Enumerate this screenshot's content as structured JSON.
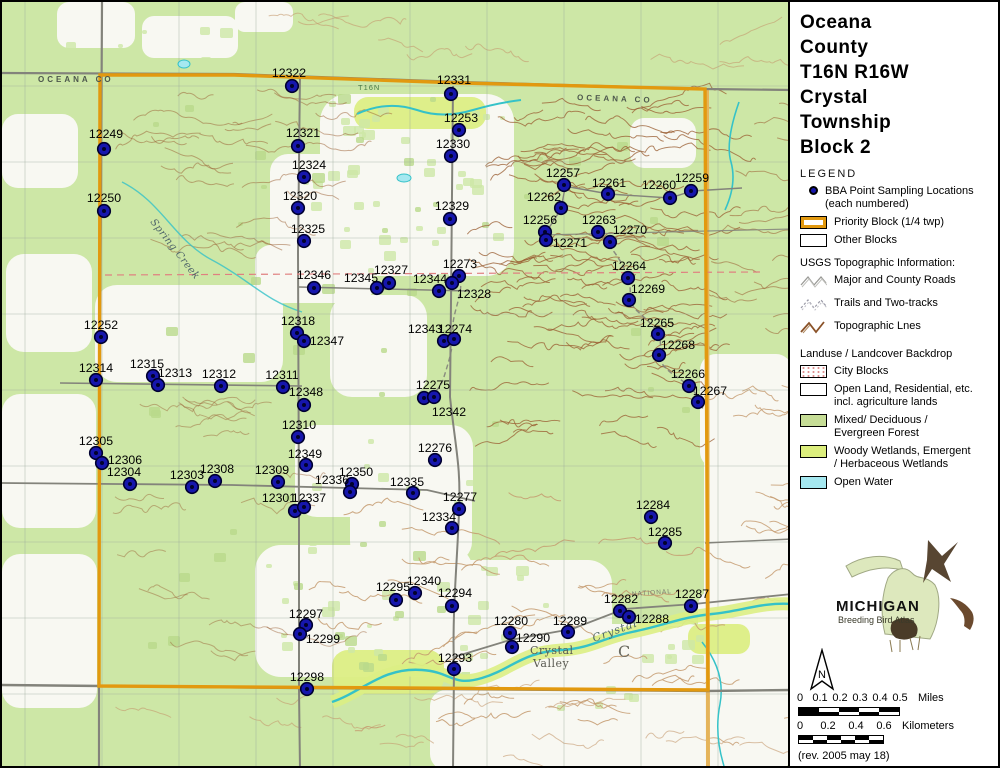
{
  "sidebar": {
    "title_lines": [
      "Oceana",
      "County",
      "T16N R16W",
      "Crystal",
      "Township",
      "Block 2"
    ],
    "legend": {
      "heading": "LEGEND",
      "bba_line1": "BBA Point Sampling Locations",
      "bba_line2": "(each numbered)",
      "priority": "Priority Block (1/4 twp)",
      "other": "Other Blocks",
      "usgs_heading": "USGS Topographic Information:",
      "roads": "Major and County Roads",
      "trails": "Trails and Two-tracks",
      "topo": "Topographic Lnes",
      "landuse_heading": "Landuse / Landcover Backdrop",
      "city": "City Blocks",
      "open1": "Open Land, Residential, etc.",
      "open2": "incl. agriculture lands",
      "forest1": "Mixed/ Deciduous /",
      "forest2": "Evergreen Forest",
      "wetland1": "Woody Wetlands, Emergent",
      "wetland2": "/ Herbaceous Wetlands",
      "water": "Open Water"
    },
    "logo": {
      "title": "MICHIGAN",
      "subtitle": "Breeding Bird Atlas"
    },
    "north_label": "N",
    "scalebar": {
      "miles_ticks": [
        "0",
        "0.1",
        "0.2",
        "0.3",
        "0.4",
        "0.5"
      ],
      "miles_unit": "Miles",
      "km_ticks": [
        "0",
        "0.2",
        "0.4",
        "0.6"
      ],
      "km_unit": "Kilometers"
    },
    "revision": "(rev. 2005 may 18)"
  },
  "map": {
    "annotations": [
      {
        "text": "OCEANA  CO",
        "x": 36,
        "y": 80,
        "rot": 0,
        "cls": "county"
      },
      {
        "text": "OCEANA  CO",
        "x": 575,
        "y": 98,
        "rot": 2,
        "cls": "county"
      },
      {
        "text": "T16N",
        "x": 356,
        "y": 88,
        "rot": 0,
        "cls": "tiny2"
      },
      {
        "text": "Spring  Creek",
        "x": 148,
        "y": 220,
        "rot": 52,
        "cls": "creek"
      },
      {
        "text": "NATIONAL",
        "x": 630,
        "y": 594,
        "rot": -4,
        "cls": "tiny"
      },
      {
        "text": "Crystal",
        "x": 528,
        "y": 652,
        "rot": 0,
        "cls": "place"
      },
      {
        "text": "Valley",
        "x": 531,
        "y": 665,
        "rot": 0,
        "cls": "place"
      },
      {
        "text": "Crystal",
        "x": 592,
        "y": 640,
        "rot": -20,
        "cls": "creekbig"
      },
      {
        "text": "C",
        "x": 616,
        "y": 655,
        "rot": 0,
        "cls": "bigc"
      }
    ],
    "points": [
      {
        "n": "12322",
        "x": 290,
        "y": 84,
        "lx": 287,
        "ly": 75
      },
      {
        "n": "12331",
        "x": 449,
        "y": 92,
        "lx": 452,
        "ly": 82
      },
      {
        "n": "12253",
        "x": 457,
        "y": 128,
        "lx": 459,
        "ly": 120
      },
      {
        "n": "12249",
        "x": 102,
        "y": 147,
        "lx": 104,
        "ly": 136
      },
      {
        "n": "12330",
        "x": 449,
        "y": 154,
        "lx": 451,
        "ly": 146
      },
      {
        "n": "12321",
        "x": 296,
        "y": 144,
        "lx": 301,
        "ly": 135
      },
      {
        "n": "12324",
        "x": 302,
        "y": 175,
        "lx": 307,
        "ly": 167
      },
      {
        "n": "12257",
        "x": 562,
        "y": 183,
        "lx": 561,
        "ly": 175
      },
      {
        "n": "12261",
        "x": 606,
        "y": 192,
        "lx": 607,
        "ly": 185
      },
      {
        "n": "12260",
        "x": 668,
        "y": 196,
        "lx": 657,
        "ly": 187
      },
      {
        "n": "12259",
        "x": 689,
        "y": 189,
        "lx": 690,
        "ly": 180
      },
      {
        "n": "12250",
        "x": 102,
        "y": 209,
        "lx": 102,
        "ly": 200
      },
      {
        "n": "12320",
        "x": 296,
        "y": 206,
        "lx": 298,
        "ly": 198
      },
      {
        "n": "12329",
        "x": 448,
        "y": 217,
        "lx": 450,
        "ly": 208
      },
      {
        "n": "12262",
        "x": 559,
        "y": 206,
        "lx": 542,
        "ly": 199
      },
      {
        "n": "12263",
        "x": 596,
        "y": 230,
        "lx": 597,
        "ly": 222
      },
      {
        "n": "12256",
        "x": 543,
        "y": 230,
        "lx": 538,
        "ly": 222
      },
      {
        "n": "12270",
        "x": 608,
        "y": 240,
        "lx": 628,
        "ly": 232
      },
      {
        "n": "12325",
        "x": 302,
        "y": 239,
        "lx": 306,
        "ly": 231
      },
      {
        "n": "12271",
        "x": 544,
        "y": 238,
        "lx": 568,
        "ly": 245
      },
      {
        "n": "12264",
        "x": 626,
        "y": 276,
        "lx": 627,
        "ly": 268
      },
      {
        "n": "12273",
        "x": 457,
        "y": 274,
        "lx": 458,
        "ly": 266
      },
      {
        "n": "12327",
        "x": 387,
        "y": 281,
        "lx": 389,
        "ly": 272
      },
      {
        "n": "12345",
        "x": 375,
        "y": 286,
        "lx": 359,
        "ly": 280
      },
      {
        "n": "12346",
        "x": 312,
        "y": 286,
        "lx": 312,
        "ly": 277
      },
      {
        "n": "12344",
        "x": 437,
        "y": 289,
        "lx": 428,
        "ly": 281
      },
      {
        "n": "12328",
        "x": 450,
        "y": 281,
        "lx": 472,
        "ly": 296
      },
      {
        "n": "12269",
        "x": 627,
        "y": 298,
        "lx": 646,
        "ly": 291
      },
      {
        "n": "12265",
        "x": 656,
        "y": 332,
        "lx": 655,
        "ly": 325
      },
      {
        "n": "12268",
        "x": 657,
        "y": 353,
        "lx": 676,
        "ly": 347
      },
      {
        "n": "12252",
        "x": 99,
        "y": 335,
        "lx": 99,
        "ly": 327
      },
      {
        "n": "12318",
        "x": 295,
        "y": 331,
        "lx": 296,
        "ly": 323
      },
      {
        "n": "12343",
        "x": 442,
        "y": 339,
        "lx": 423,
        "ly": 331
      },
      {
        "n": "12274",
        "x": 452,
        "y": 337,
        "lx": 453,
        "ly": 331
      },
      {
        "n": "12347",
        "x": 302,
        "y": 339,
        "lx": 325,
        "ly": 343
      },
      {
        "n": "12314",
        "x": 94,
        "y": 378,
        "lx": 94,
        "ly": 370
      },
      {
        "n": "12315",
        "x": 151,
        "y": 374,
        "lx": 145,
        "ly": 366
      },
      {
        "n": "12313",
        "x": 156,
        "y": 383,
        "lx": 173,
        "ly": 375
      },
      {
        "n": "12312",
        "x": 219,
        "y": 384,
        "lx": 217,
        "ly": 376
      },
      {
        "n": "12311",
        "x": 281,
        "y": 385,
        "lx": 280,
        "ly": 377
      },
      {
        "n": "12266",
        "x": 687,
        "y": 384,
        "lx": 686,
        "ly": 376
      },
      {
        "n": "12275",
        "x": 422,
        "y": 396,
        "lx": 431,
        "ly": 387
      },
      {
        "n": "12267",
        "x": 696,
        "y": 400,
        "lx": 708,
        "ly": 393
      },
      {
        "n": "12348",
        "x": 302,
        "y": 403,
        "lx": 304,
        "ly": 394
      },
      {
        "n": "12342",
        "x": 432,
        "y": 395,
        "lx": 447,
        "ly": 414
      },
      {
        "n": "12310",
        "x": 296,
        "y": 435,
        "lx": 297,
        "ly": 427
      },
      {
        "n": "12305",
        "x": 94,
        "y": 451,
        "lx": 94,
        "ly": 443
      },
      {
        "n": "12306",
        "x": 100,
        "y": 461,
        "lx": 123,
        "ly": 462
      },
      {
        "n": "12349",
        "x": 304,
        "y": 463,
        "lx": 303,
        "ly": 456
      },
      {
        "n": "12276",
        "x": 433,
        "y": 458,
        "lx": 433,
        "ly": 450
      },
      {
        "n": "12304",
        "x": 128,
        "y": 482,
        "lx": 122,
        "ly": 474
      },
      {
        "n": "12303",
        "x": 190,
        "y": 485,
        "lx": 185,
        "ly": 477
      },
      {
        "n": "12308",
        "x": 213,
        "y": 479,
        "lx": 215,
        "ly": 471
      },
      {
        "n": "12309",
        "x": 276,
        "y": 480,
        "lx": 270,
        "ly": 472
      },
      {
        "n": "12350",
        "x": 350,
        "y": 482,
        "lx": 354,
        "ly": 474
      },
      {
        "n": "12335",
        "x": 411,
        "y": 491,
        "lx": 405,
        "ly": 484
      },
      {
        "n": "12336",
        "x": 348,
        "y": 490,
        "lx": 330,
        "ly": 482
      },
      {
        "n": "12277",
        "x": 457,
        "y": 507,
        "lx": 458,
        "ly": 499
      },
      {
        "n": "12301",
        "x": 293,
        "y": 509,
        "lx": 277,
        "ly": 500
      },
      {
        "n": "12337",
        "x": 302,
        "y": 505,
        "lx": 307,
        "ly": 500
      },
      {
        "n": "12334",
        "x": 450,
        "y": 526,
        "lx": 437,
        "ly": 519
      },
      {
        "n": "12284",
        "x": 649,
        "y": 515,
        "lx": 651,
        "ly": 507
      },
      {
        "n": "12285",
        "x": 663,
        "y": 541,
        "lx": 663,
        "ly": 534
      },
      {
        "n": "12340",
        "x": 413,
        "y": 591,
        "lx": 422,
        "ly": 583
      },
      {
        "n": "12295",
        "x": 394,
        "y": 598,
        "lx": 391,
        "ly": 589
      },
      {
        "n": "12294",
        "x": 450,
        "y": 604,
        "lx": 453,
        "ly": 595
      },
      {
        "n": "12287",
        "x": 689,
        "y": 604,
        "lx": 690,
        "ly": 596
      },
      {
        "n": "12282",
        "x": 618,
        "y": 609,
        "lx": 619,
        "ly": 601
      },
      {
        "n": "12288",
        "x": 627,
        "y": 615,
        "lx": 650,
        "ly": 621
      },
      {
        "n": "12289",
        "x": 566,
        "y": 630,
        "lx": 568,
        "ly": 623
      },
      {
        "n": "12280",
        "x": 508,
        "y": 631,
        "lx": 509,
        "ly": 623
      },
      {
        "n": "12290",
        "x": 510,
        "y": 645,
        "lx": 531,
        "ly": 640
      },
      {
        "n": "12297",
        "x": 304,
        "y": 623,
        "lx": 304,
        "ly": 616
      },
      {
        "n": "12299",
        "x": 298,
        "y": 632,
        "lx": 321,
        "ly": 641
      },
      {
        "n": "12293",
        "x": 452,
        "y": 667,
        "lx": 453,
        "ly": 660
      },
      {
        "n": "12298",
        "x": 305,
        "y": 687,
        "lx": 305,
        "ly": 679
      }
    ]
  },
  "colors": {
    "forest": "#cde7a6",
    "open": "#f8f8f2",
    "wetland": "#dcee84",
    "water": "#35c2c8",
    "contour": "#9a5d32",
    "contour_light": "#c49a6e",
    "road": "#83837b",
    "priority_border": "#e2990f",
    "point": "#1616ad"
  }
}
